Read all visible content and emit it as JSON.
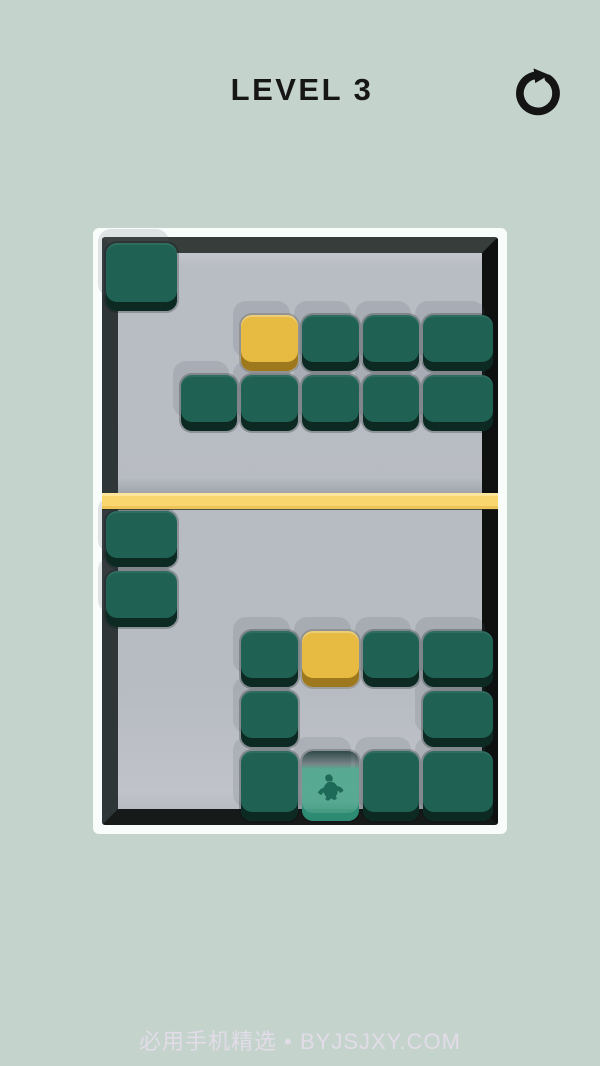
{
  "header": {
    "title": "LEVEL 3",
    "restart_icon": "restart-circular-arrow-icon"
  },
  "board": {
    "columns": 6,
    "cell_legend": {
      "G": "green-block",
      "Y": "yellow-block",
      "C": "creature-goal-block",
      ".": "empty"
    },
    "top_section": {
      "rows": 4,
      "grid": [
        "G.....",
        "..YGGG",
        ".GGGGG",
        "......"
      ]
    },
    "divider_bar": {
      "color": "#f9d66e"
    },
    "bottom_section": {
      "rows": 5,
      "grid": [
        "G.....",
        "G.....",
        "..GYGG",
        "..G..G",
        "..GCGG"
      ]
    }
  },
  "footer": {
    "watermark": "必用手机精选 • BYJSJXY.COM"
  },
  "colors": {
    "background": "#c4d3cb",
    "title_text": "#161616",
    "frame_white": "#f8fcfa",
    "frame_dark_top": "#363d3a",
    "frame_dark_right": "#0e1110",
    "frame_dark_bottom": "#161a19",
    "frame_dark_left": "#2f3637",
    "field_gray": "#b7bbc2",
    "block_green": "#1f6253",
    "block_green_side": "#0c2922",
    "block_yellow": "#e7bb42",
    "block_yellow_side": "#9d781d",
    "divider_yellow": "#f9d66e",
    "goal_teal": "#54a990",
    "creature_silhouette": "#14604e",
    "watermark_text": "#eadff0"
  }
}
